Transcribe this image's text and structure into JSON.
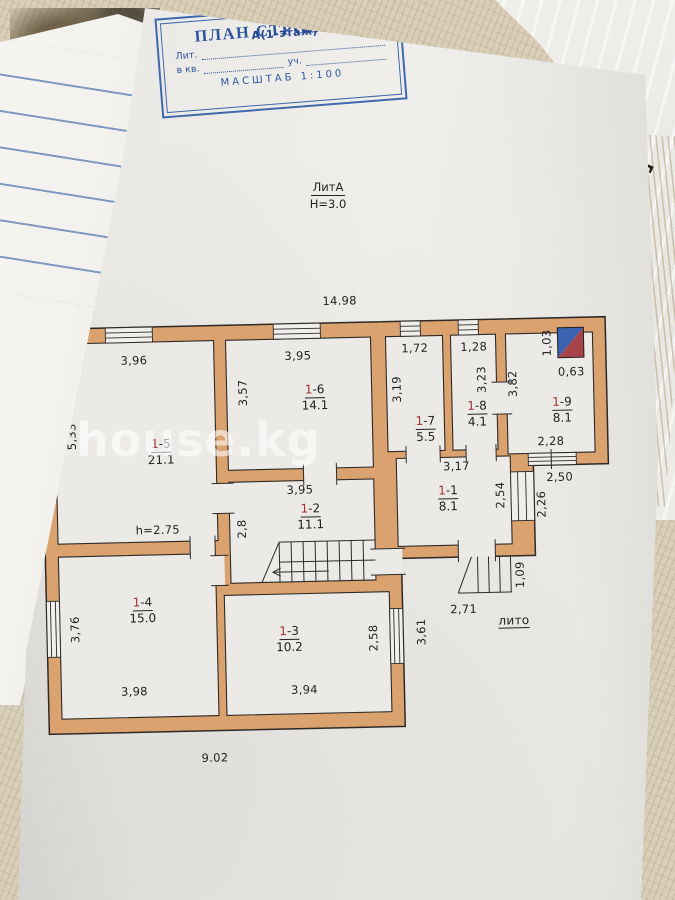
{
  "stamp": {
    "title": "ПЛАН СТРОЕНИЙ",
    "lit_label": "Лит.",
    "lit_value": "А(1-этаж)",
    "kv_label": "в кв.",
    "uch_label": "уч.",
    "scale": "МАСШТАБ 1:100"
  },
  "header": {
    "lit": "ЛитА",
    "height": "Н=3.0"
  },
  "watermark": {
    "text": "house.kg"
  },
  "background": {
    "cert_letter": "S"
  },
  "colors": {
    "wall": "#d9a26f",
    "stamp_blue": "#2d55a0",
    "room_number_red": "#a03434",
    "mark_blue": "#3a62b0",
    "mark_red": "#a8434b"
  },
  "plan": {
    "top_dim": "14.98",
    "left_dim": "10.10",
    "bottom_dim": "9.02",
    "h_note": "h=2.75",
    "lito": "лито",
    "rooms": [
      {
        "n1": "1",
        "n2": "-1",
        "area": "8.1",
        "w": "3,17",
        "h": "2,54"
      },
      {
        "n1": "1",
        "n2": "-2",
        "area": "11.1",
        "w": "3,95",
        "h": "2,8"
      },
      {
        "n1": "1",
        "n2": "-3",
        "area": "10.2",
        "w": "3,94",
        "h": "2,58"
      },
      {
        "n1": "1",
        "n2": "-4",
        "area": "15.0",
        "w": "3,98",
        "h": "3,76"
      },
      {
        "n1": "1",
        "n2": "-5",
        "area": "21.1",
        "w": "3,96",
        "h": "5,33"
      },
      {
        "n1": "1",
        "n2": "-6",
        "area": "14.1",
        "w": "3,95",
        "h": "3,57"
      },
      {
        "n1": "1",
        "n2": "-7",
        "area": "5.5",
        "w": "1,72",
        "h": "3,19"
      },
      {
        "n1": "1",
        "n2": "-8",
        "area": "4.1",
        "w": "1,28",
        "h": "3,23"
      },
      {
        "n1": "1",
        "n2": "-9",
        "area": "8.1",
        "w": "2,28",
        "h": "3,82"
      }
    ],
    "extra_dims": {
      "d103": "1,03",
      "d063": "0,63",
      "d250": "2,50",
      "d226": "2,26",
      "d109": "1,09",
      "d271": "2,71",
      "d361": "3,61"
    }
  }
}
